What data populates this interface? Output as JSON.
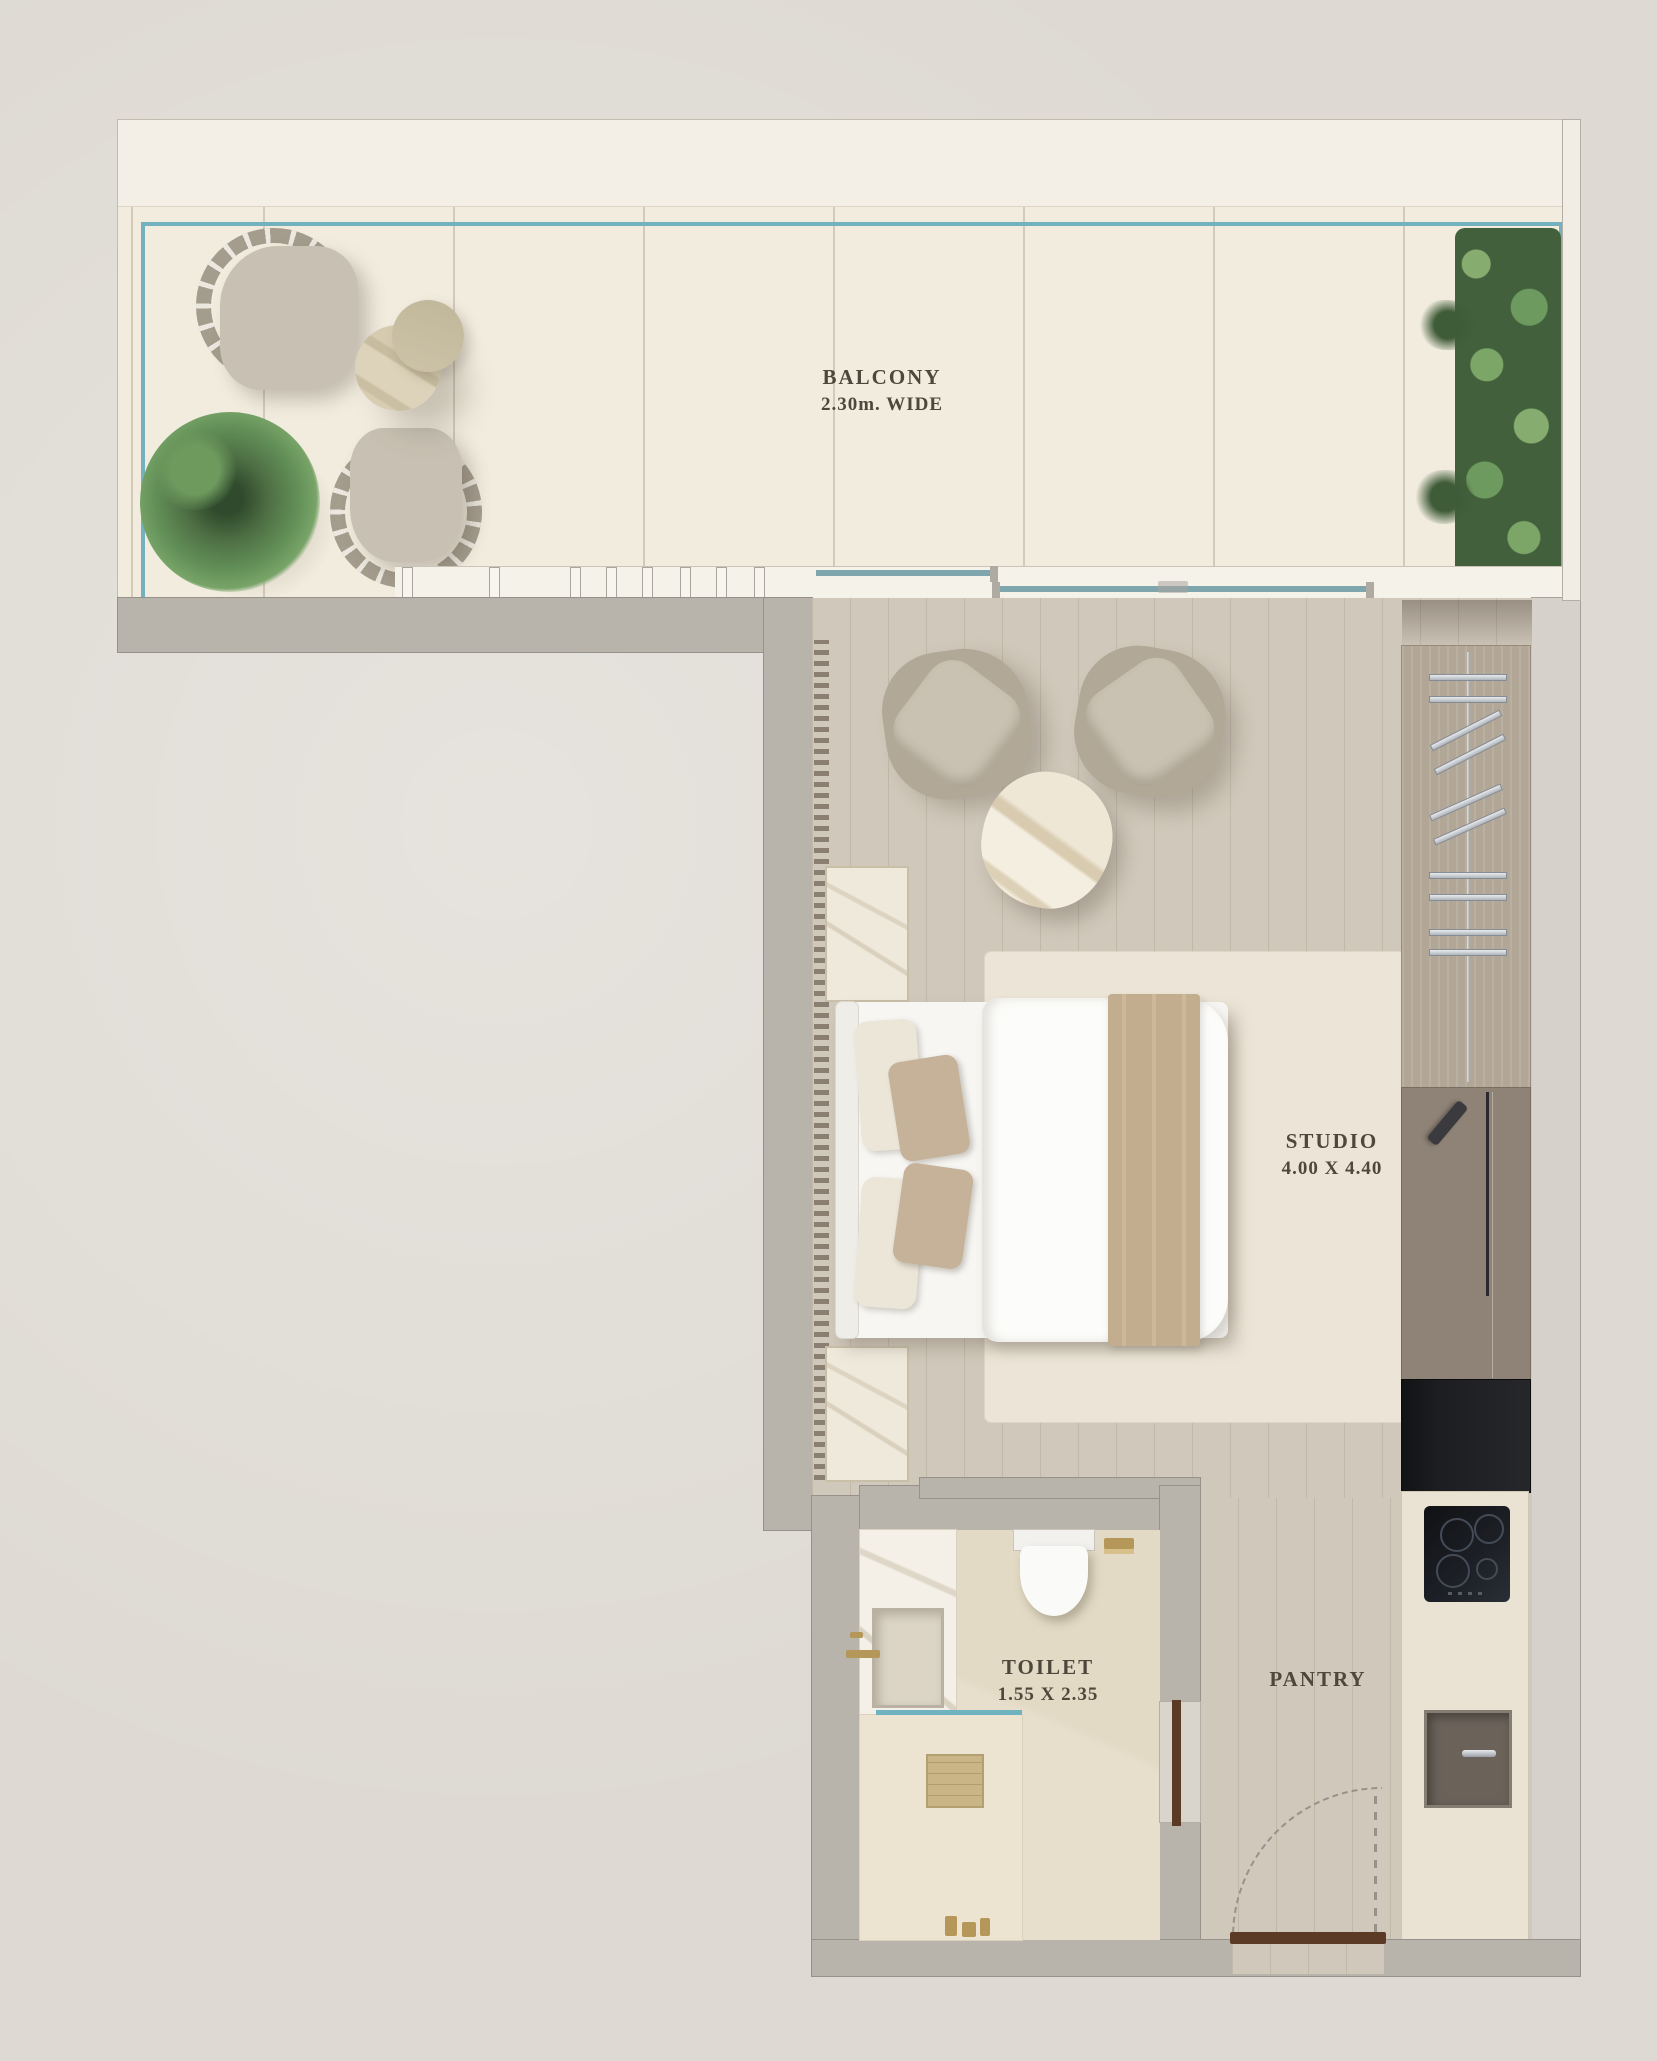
{
  "plan": {
    "balcony": {
      "label": "BALCONY",
      "dimension": "2.30m. WIDE"
    },
    "studio": {
      "label": "STUDIO",
      "dimension": "4.00 X 4.40"
    },
    "toilet": {
      "label": "TOILET",
      "dimension": "1.55 X 2.35"
    },
    "pantry": {
      "label": "PANTRY"
    }
  },
  "colors": {
    "background": "#dedad3",
    "balcony_tile": "#f2ecdf",
    "glass_accent": "#74b1bf",
    "wall": "#b9b4ab",
    "wood_floor": "#d0c8ba",
    "door_wood": "#5c3b26",
    "appliance_black": "#1d1e21",
    "brass": "#b5975a",
    "plant_green": "#5d8050",
    "label_text": "#4f473c"
  }
}
